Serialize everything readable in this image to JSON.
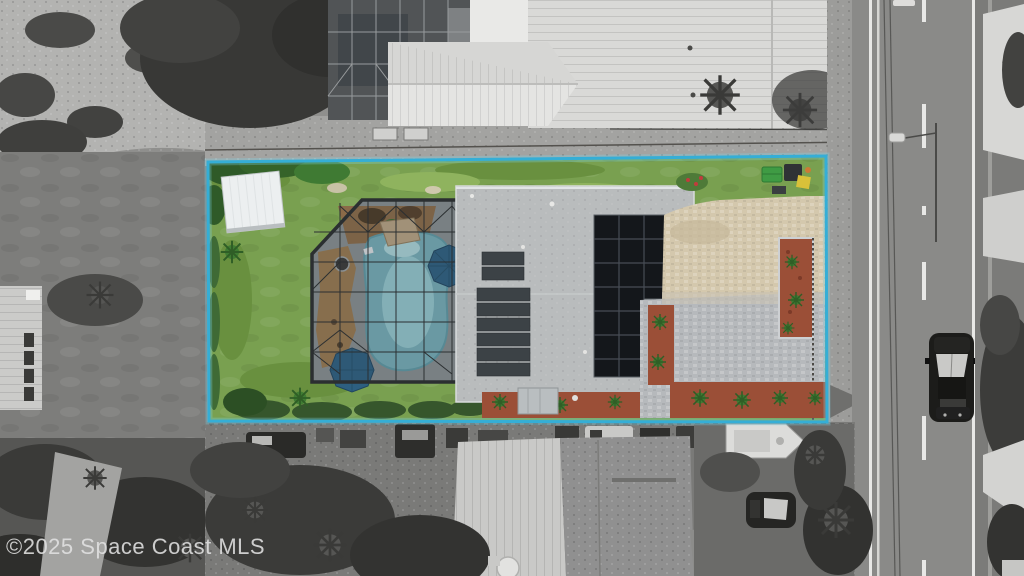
{
  "watermark": {
    "text": "©2025 Space Coast MLS"
  },
  "scene": {
    "type": "aerial-drone-photo",
    "highlight": "subject property shown in color inside cyan lot-boundary outline; surroundings desaturated grayscale",
    "objects": [
      "lot-boundary",
      "lawn",
      "storage-shed",
      "pool-screen-enclosure",
      "swimming-pool",
      "patio-umbrellas",
      "main-house-roof",
      "pool-solar-panels",
      "solar-pv-array",
      "paver-patio-driveway",
      "mulch-planting-beds",
      "trash-bins",
      "neighbor-house-north",
      "neighbor-house-south",
      "road",
      "black-vehicle-on-road",
      "boat",
      "parked-suv",
      "power-lines",
      "streetlight"
    ]
  },
  "colors": {
    "boundary": "#35aed6",
    "boundary_glow": "#7fd8ea",
    "lawn": "#79a050",
    "lawn_dark": "#69903f",
    "lawn_light": "#8fb35e",
    "pool_water": "#74abb6",
    "pool_water_light": "#9ccdd3",
    "enclosure_deck": "#868d90",
    "enclosure_frame": "#2b2f31",
    "roof": "#b9bcbd",
    "pv_panel": "#14171b",
    "pv_grid": "#474d55",
    "pool_solar": "#3c4246",
    "paver_tan": "#d4c8ad",
    "paver_gray": "#b6b9bc",
    "mulch_red": "#9b4f37",
    "mulch_brown": "#8a6a48",
    "shed": "#eceff0",
    "umbrella": "#2d5f80",
    "palm": "#3f7c33",
    "trash_green": "#3f9b44",
    "trash_yellow": "#d9c139",
    "road": "#8a8a88",
    "road_line": "#e8e8e6",
    "metal_roof": "#d9d9d7",
    "watermark_color": "#e2e2e2"
  }
}
